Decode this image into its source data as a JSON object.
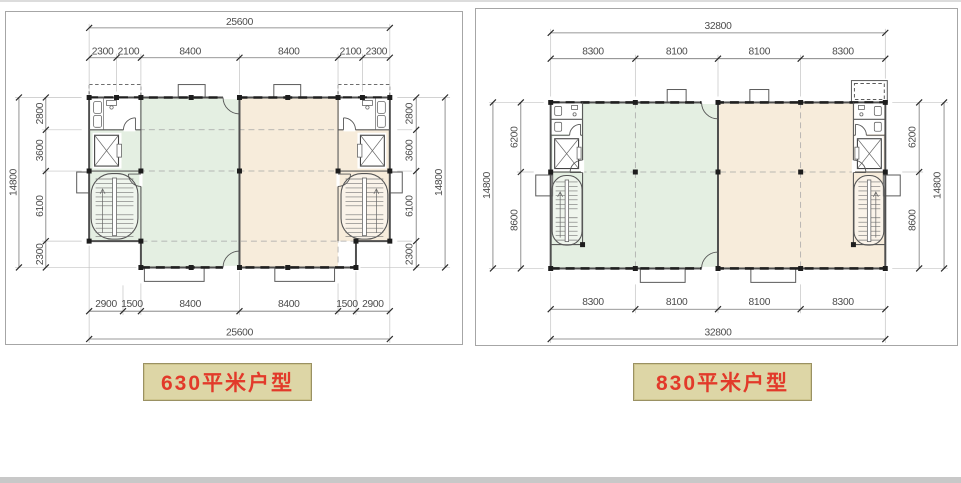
{
  "page": {
    "background": "#ffffff",
    "top_rule_color": "#dcdcdc",
    "footer_bar_color": "#c8c8c8"
  },
  "colors": {
    "green_zone": "#e4efe2",
    "tan_zone": "#f7ecdb",
    "wall": "#4f4f4f",
    "dimension_text": "#4c4c4c",
    "label_background": "#ddd6a6",
    "label_border": "#9a9163",
    "label_text": "#e23a2a"
  },
  "plans": [
    {
      "id": "plan-630",
      "label": "630平米户型",
      "dims": {
        "top_total": "25600",
        "top_segments": [
          "2300",
          "2100",
          "8400",
          "8400",
          "2100",
          "2300"
        ],
        "bottom_segments": [
          "2900",
          "1500",
          "8400",
          "8400",
          "1500",
          "2900"
        ],
        "bottom_total": "25600",
        "left_outer": "14800",
        "left_inner": [
          "2800",
          "3600",
          "6100",
          "2300"
        ],
        "right_inner": [
          "2800",
          "3600",
          "6100",
          "2300"
        ],
        "right_outer": "14800"
      }
    },
    {
      "id": "plan-830",
      "label": "830平米户型",
      "dims": {
        "top_total": "32800",
        "top_segments": [
          "8300",
          "8100",
          "8100",
          "8300"
        ],
        "bottom_segments": [
          "8300",
          "8100",
          "8100",
          "8300"
        ],
        "bottom_total": "32800",
        "left_outer": "14800",
        "left_inner": [
          "6200",
          "8600"
        ],
        "right_inner": [
          "6200",
          "8600"
        ],
        "right_outer": "14800"
      }
    }
  ]
}
